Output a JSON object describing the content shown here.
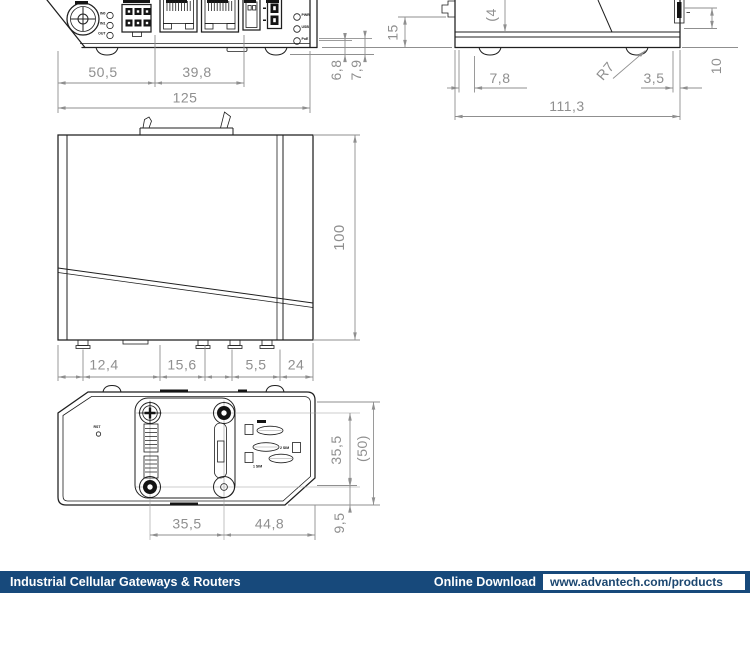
{
  "dims": {
    "front": {
      "w1": "50,5",
      "w2": "39,8",
      "total": "125",
      "v1": "6,8",
      "v2": "7,9",
      "clip": "15"
    },
    "side": {
      "cut": "(4",
      "left": "7,8",
      "right": "3,5",
      "total": "111,3",
      "radius": "R7",
      "v": "10"
    },
    "top": {
      "h": "100",
      "b1": "12,4",
      "b2": "15,6",
      "b3": "5,5",
      "b4": "24"
    },
    "bottom": {
      "w1": "35,5",
      "w2": "44,8",
      "v1": "35,5",
      "v2": "(50)",
      "v3": "9,5"
    }
  },
  "panel": {
    "io": [
      "IN0",
      "IN1",
      "OUT"
    ],
    "leds": [
      "PWR",
      "USB",
      "PoE"
    ]
  },
  "bottom_labels": {
    "rst": "RST",
    "sim2": "2 SIM",
    "sim1": "1 SIM"
  },
  "footer": {
    "title": "Industrial Cellular Gateways & Routers",
    "download": "Online Download",
    "url": "www.advantech.com/products"
  },
  "colors": {
    "footer_bar": "#17497B",
    "drawing_line": "#1f1f1f",
    "dimension_gray": "#8f8f8f"
  }
}
